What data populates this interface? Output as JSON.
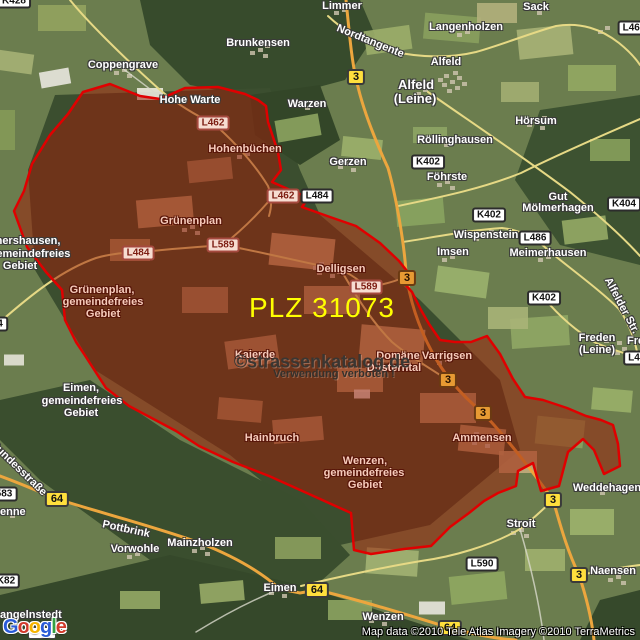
{
  "map": {
    "plz": {
      "text": "PLZ 31073",
      "color": "#ffff00"
    },
    "watermark": {
      "line1": "©strassenkatalog.de",
      "line2": "Verwendung verboten !"
    },
    "attribution": "Map data ©2010 Tele Atlas  Imagery ©2010 TerraMetrics",
    "logo": {
      "letters": [
        {
          "ch": "G",
          "color": "#2a5bd7"
        },
        {
          "ch": "o",
          "color": "#d23b2c"
        },
        {
          "ch": "o",
          "color": "#f5b400"
        },
        {
          "ch": "g",
          "color": "#2a5bd7"
        },
        {
          "ch": "l",
          "color": "#34a043"
        },
        {
          "ch": "e",
          "color": "#d23b2c"
        }
      ]
    },
    "region": {
      "name": "PLZ 31073 boundary",
      "fill": "rgba(158,28,8,0.52)",
      "stroke": "#e00000",
      "outline": [
        [
          83,
          92
        ],
        [
          110,
          84
        ],
        [
          140,
          96
        ],
        [
          160,
          99
        ],
        [
          185,
          88
        ],
        [
          218,
          87
        ],
        [
          245,
          94
        ],
        [
          258,
          100
        ],
        [
          266,
          106
        ],
        [
          268,
          122
        ],
        [
          278,
          152
        ],
        [
          281,
          170
        ],
        [
          272,
          182
        ],
        [
          297,
          193
        ],
        [
          309,
          197
        ],
        [
          302,
          207
        ],
        [
          330,
          217
        ],
        [
          356,
          226
        ],
        [
          380,
          243
        ],
        [
          399,
          261
        ],
        [
          407,
          271
        ],
        [
          403,
          282
        ],
        [
          412,
          292
        ],
        [
          421,
          310
        ],
        [
          429,
          324
        ],
        [
          440,
          340
        ],
        [
          455,
          342
        ],
        [
          471,
          342
        ],
        [
          487,
          336
        ],
        [
          500,
          354
        ],
        [
          513,
          379
        ],
        [
          525,
          397
        ],
        [
          543,
          400
        ],
        [
          567,
          408
        ],
        [
          586,
          416
        ],
        [
          601,
          420
        ],
        [
          613,
          425
        ],
        [
          618,
          444
        ],
        [
          620,
          466
        ],
        [
          604,
          474
        ],
        [
          594,
          450
        ],
        [
          583,
          439
        ],
        [
          568,
          452
        ],
        [
          559,
          486
        ],
        [
          541,
          491
        ],
        [
          533,
          463
        ],
        [
          518,
          471
        ],
        [
          516,
          486
        ],
        [
          498,
          493
        ],
        [
          484,
          501
        ],
        [
          469,
          513
        ],
        [
          450,
          527
        ],
        [
          431,
          546
        ],
        [
          404,
          549
        ],
        [
          371,
          554
        ],
        [
          354,
          550
        ],
        [
          351,
          513
        ],
        [
          309,
          494
        ],
        [
          269,
          476
        ],
        [
          233,
          462
        ],
        [
          199,
          446
        ],
        [
          176,
          431
        ],
        [
          129,
          406
        ],
        [
          106,
          388
        ],
        [
          84,
          354
        ],
        [
          76,
          342
        ],
        [
          65,
          320
        ],
        [
          62,
          290
        ],
        [
          46,
          272
        ],
        [
          27,
          247
        ],
        [
          14,
          211
        ],
        [
          24,
          191
        ],
        [
          32,
          164
        ],
        [
          50,
          135
        ],
        [
          68,
          114
        ]
      ]
    },
    "places": [
      {
        "t": "Limmer",
        "x": 342,
        "y": 7
      },
      {
        "t": "Sack",
        "x": 536,
        "y": 8
      },
      {
        "t": "Langenholzen",
        "x": 466,
        "y": 28
      },
      {
        "t": "Brunkensen",
        "x": 258,
        "y": 44
      },
      {
        "t": "Alfeld",
        "x": 446,
        "y": 63
      },
      {
        "t": "Coppengrave",
        "x": 123,
        "y": 66
      },
      {
        "t": "Alfeld",
        "x": 416,
        "y": 85,
        "s": "big"
      },
      {
        "t": "(Leine)",
        "x": 415,
        "y": 99,
        "s": "big"
      },
      {
        "t": "Warzen",
        "x": 307,
        "y": 105
      },
      {
        "t": "Hohe Warte",
        "x": 190,
        "y": 101
      },
      {
        "t": "Röllinghausen",
        "x": 455,
        "y": 141
      },
      {
        "t": "Hörsum",
        "x": 536,
        "y": 122
      },
      {
        "t": "Gerzen",
        "x": 348,
        "y": 163
      },
      {
        "t": "Föhrste",
        "x": 447,
        "y": 178
      },
      {
        "t": "Gut",
        "x": 558,
        "y": 198
      },
      {
        "t": "Mölmerhagen",
        "x": 558,
        "y": 209
      },
      {
        "t": "Wispenstein",
        "x": 486,
        "y": 236
      },
      {
        "t": "Imsen",
        "x": 453,
        "y": 253
      },
      {
        "t": "Meimerhausen",
        "x": 548,
        "y": 254
      },
      {
        "t": "hershausen,",
        "x": 28,
        "y": 242
      },
      {
        "t": "gemeindefreies",
        "x": 30,
        "y": 255
      },
      {
        "t": "Gebiet",
        "x": 20,
        "y": 267
      },
      {
        "t": "Freden",
        "x": 597,
        "y": 339
      },
      {
        "t": "(Leine)",
        "x": 597,
        "y": 351
      },
      {
        "t": "Fre",
        "x": 627,
        "y": 342,
        "align": "left"
      },
      {
        "t": "Eimen,",
        "x": 81,
        "y": 389
      },
      {
        "t": "gemeindefreies",
        "x": 82,
        "y": 402
      },
      {
        "t": "Gebiet",
        "x": 81,
        "y": 414
      },
      {
        "t": "Weddehagen",
        "x": 607,
        "y": 489
      },
      {
        "t": "Stroit",
        "x": 521,
        "y": 525
      },
      {
        "t": "enne",
        "x": 0,
        "y": 513,
        "align": "left"
      },
      {
        "t": "Mainzholzen",
        "x": 200,
        "y": 544
      },
      {
        "t": "Vorwohle",
        "x": 135,
        "y": 550
      },
      {
        "t": "Pottbrink",
        "x": 126,
        "y": 530,
        "r": 12
      },
      {
        "t": "Naensen",
        "x": 613,
        "y": 572
      },
      {
        "t": "Eimen",
        "x": 280,
        "y": 589
      },
      {
        "t": "Wenzen",
        "x": 383,
        "y": 618
      },
      {
        "t": "angelnstedt",
        "x": 0,
        "y": 616,
        "align": "left"
      },
      {
        "t": "Nordtangente",
        "x": 370,
        "y": 42,
        "r": 22
      },
      {
        "t": "Alfelder Str.",
        "x": 621,
        "y": 306,
        "r": 62
      },
      {
        "t": "Bundesstraße",
        "x": 18,
        "y": 469,
        "r": 44
      },
      {
        "t": "Hohenbüchen",
        "x": 245,
        "y": 150,
        "s": "pink"
      },
      {
        "t": "Grünenplan",
        "x": 191,
        "y": 222,
        "s": "pink"
      },
      {
        "t": "Grünenplan,",
        "x": 102,
        "y": 291,
        "s": "pink"
      },
      {
        "t": "gemeindefreies",
        "x": 103,
        "y": 303,
        "s": "pink"
      },
      {
        "t": "Gebiet",
        "x": 103,
        "y": 315,
        "s": "pink"
      },
      {
        "t": "Delligsen",
        "x": 341,
        "y": 270,
        "s": "pink"
      },
      {
        "t": "Kaierde",
        "x": 255,
        "y": 356,
        "s": "pink"
      },
      {
        "t": "Domäne",
        "x": 398,
        "y": 357,
        "s": "pink"
      },
      {
        "t": "Düsterntal",
        "x": 394,
        "y": 369,
        "s": "pink"
      },
      {
        "t": "Varrigsen",
        "x": 447,
        "y": 357,
        "s": "pink"
      },
      {
        "t": "Hainbruch",
        "x": 272,
        "y": 439,
        "s": "pink"
      },
      {
        "t": "Wenzen,",
        "x": 365,
        "y": 462,
        "s": "pink"
      },
      {
        "t": "gemeindefreies",
        "x": 364,
        "y": 474,
        "s": "pink"
      },
      {
        "t": "Gebiet",
        "x": 365,
        "y": 486,
        "s": "pink"
      },
      {
        "t": "Ammensen",
        "x": 482,
        "y": 439,
        "s": "pink"
      }
    ],
    "road_labels": [
      {
        "t": "K428",
        "x": 14,
        "y": 1,
        "v": "white"
      },
      {
        "t": "L468",
        "x": 634,
        "y": 28,
        "v": "white"
      },
      {
        "t": "K402",
        "x": 428,
        "y": 162,
        "v": "white"
      },
      {
        "t": "K402",
        "x": 489,
        "y": 215,
        "v": "white"
      },
      {
        "t": "K402",
        "x": 544,
        "y": 298,
        "v": "white"
      },
      {
        "t": "K404",
        "x": 624,
        "y": 204,
        "v": "white"
      },
      {
        "t": "L486",
        "x": 535,
        "y": 238,
        "v": "white"
      },
      {
        "t": "L484",
        "x": 317,
        "y": 196,
        "v": "white"
      },
      {
        "t": "L590",
        "x": 482,
        "y": 564,
        "v": "white"
      },
      {
        "t": "L4",
        "x": 634,
        "y": 358,
        "v": "white"
      },
      {
        "t": "583",
        "x": 4,
        "y": 494,
        "v": "white"
      },
      {
        "t": "K82",
        "x": 6,
        "y": 581,
        "v": "white"
      },
      {
        "t": "4",
        "x": 0,
        "y": 324,
        "v": "white"
      },
      {
        "t": "L462",
        "x": 213,
        "y": 123,
        "v": "pink"
      },
      {
        "t": "L462",
        "x": 283,
        "y": 196,
        "v": "pink"
      },
      {
        "t": "L484",
        "x": 138,
        "y": 253,
        "v": "pink"
      },
      {
        "t": "L589",
        "x": 223,
        "y": 245,
        "v": "pink"
      },
      {
        "t": "L589",
        "x": 366,
        "y": 287,
        "v": "pink"
      }
    ],
    "route_badges": [
      {
        "t": "3",
        "x": 356,
        "y": 77,
        "v": "yellow"
      },
      {
        "t": "3",
        "x": 553,
        "y": 500,
        "v": "yellow"
      },
      {
        "t": "3",
        "x": 579,
        "y": 575,
        "v": "yellow"
      },
      {
        "t": "3",
        "x": 407,
        "y": 278,
        "v": "orange"
      },
      {
        "t": "3",
        "x": 448,
        "y": 380,
        "v": "orange"
      },
      {
        "t": "3",
        "x": 483,
        "y": 413,
        "v": "orange"
      },
      {
        "t": "64",
        "x": 57,
        "y": 499,
        "v": "yellow"
      },
      {
        "t": "64",
        "x": 317,
        "y": 590,
        "v": "yellow"
      },
      {
        "t": "64",
        "x": 450,
        "y": 628,
        "v": "yellow"
      }
    ],
    "colors": {
      "road_major": "#eca63e",
      "road_minor": "#e6d985",
      "forest": "#3b4e2f",
      "field_base": "#6b7d4e"
    }
  }
}
